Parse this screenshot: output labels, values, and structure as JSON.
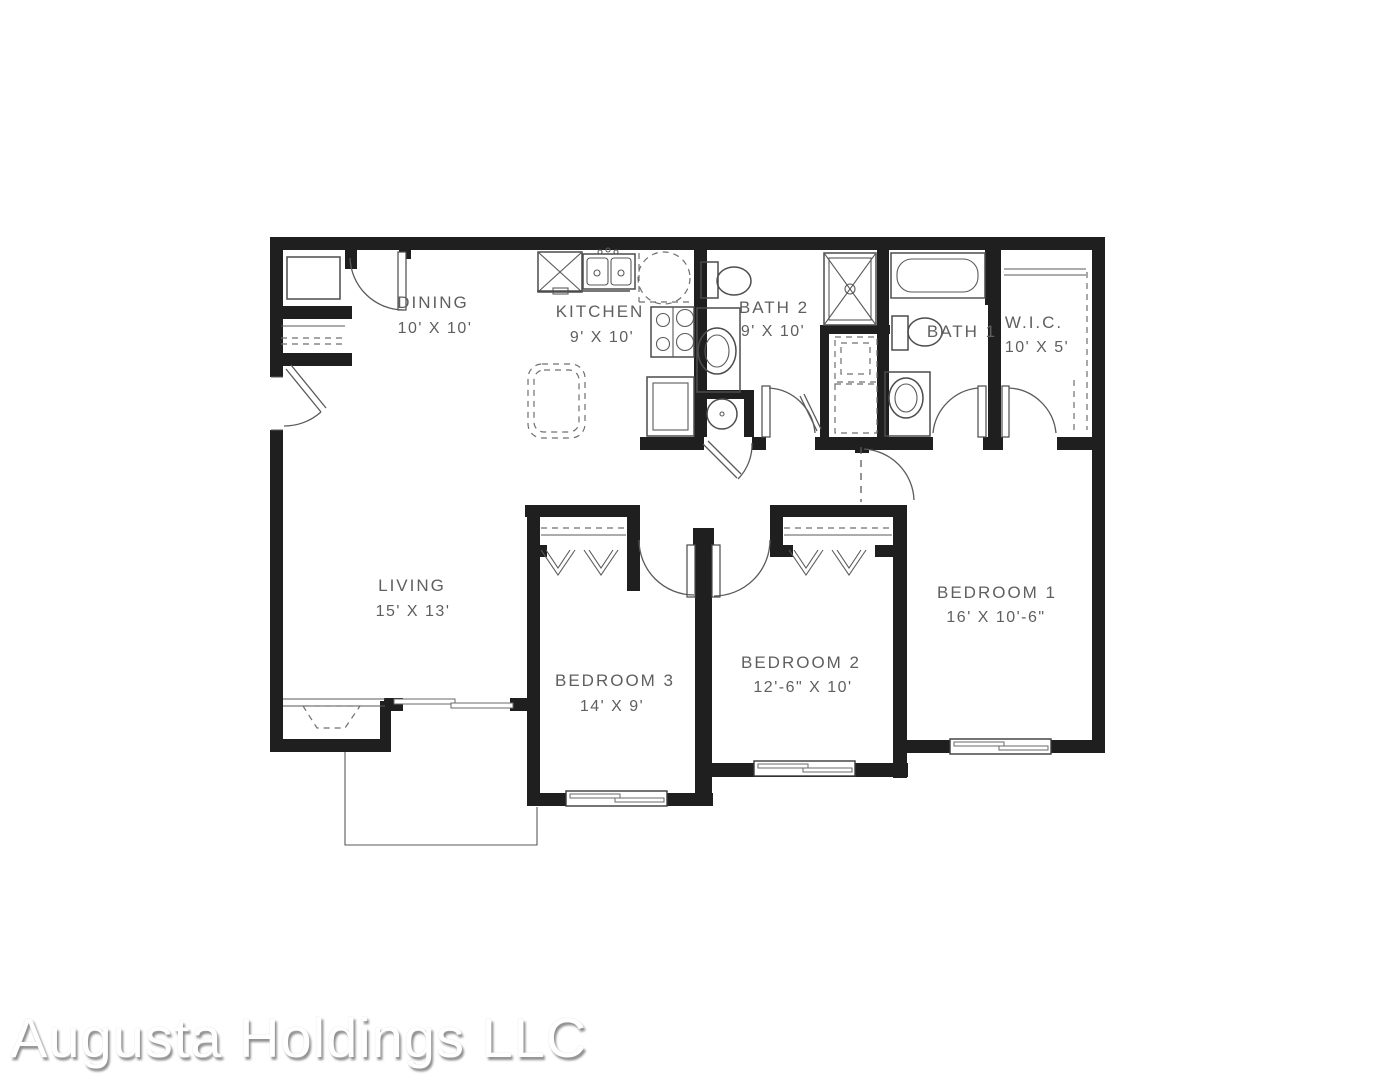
{
  "floor_plan": {
    "rooms": [
      {
        "id": "dining",
        "name": "DINING",
        "dims": "10' X 10'"
      },
      {
        "id": "kitchen",
        "name": "KITCHEN",
        "dims": "9' X 10'"
      },
      {
        "id": "bath2",
        "name": "BATH 2",
        "dims": "9' X 10'"
      },
      {
        "id": "bath1",
        "name": "BATH 1",
        "dims": ""
      },
      {
        "id": "wic",
        "name": "W.I.C.",
        "dims": "10' X 5'"
      },
      {
        "id": "living",
        "name": "LIVING",
        "dims": "15' X 13'"
      },
      {
        "id": "bedroom3",
        "name": "BEDROOM 3",
        "dims": "14' X 9'"
      },
      {
        "id": "bedroom2",
        "name": "BEDROOM 2",
        "dims": "12'-6\" X 10'"
      },
      {
        "id": "bedroom1",
        "name": "BEDROOM 1",
        "dims": "16' X 10'-6\""
      }
    ],
    "watermark": "Augusta Holdings LLC",
    "colors": {
      "walls": "#1f1f1f",
      "labels": "#5f5f5f",
      "fixtures": "#4c4c4c",
      "watermark_shadow": "#8f8f8f"
    }
  }
}
